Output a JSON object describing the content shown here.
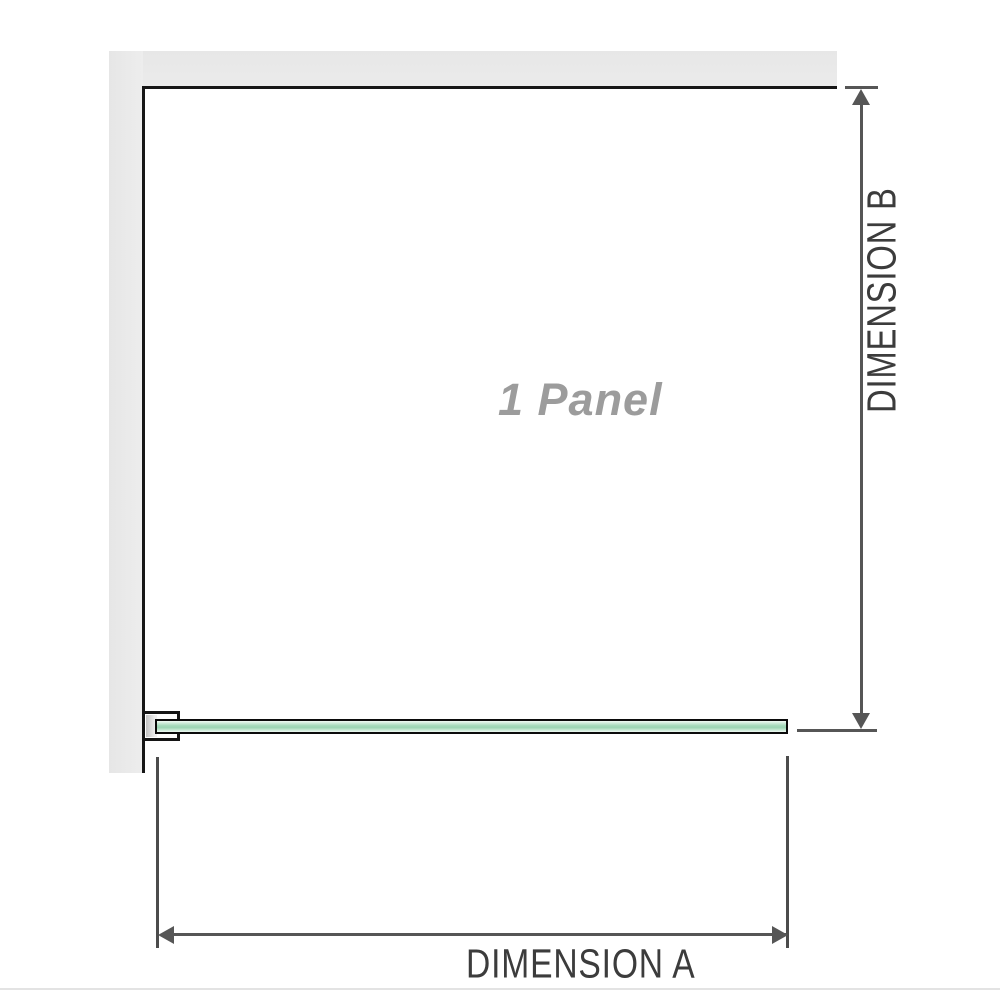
{
  "diagram": {
    "panel_label": "1 Panel",
    "dimension_a": {
      "label": "DIMENSION A",
      "orientation": "horizontal",
      "measures": "panel width"
    },
    "dimension_b": {
      "label": "DIMENSION B",
      "orientation": "vertical",
      "measures": "panel height"
    },
    "parts": {
      "wall": "L-shaped wall shown top and left",
      "glass": "single glass panel shown in plan view with wall bracket at left end"
    }
  },
  "colors": {
    "background": "#ffffff",
    "wall_gray": "#e9e9e9",
    "panel_outline": "#161616",
    "dimension_line": "#565656",
    "dimension_text": "#3c3c3c",
    "panel_label_text": "#9c9c9c",
    "glass_green": "#a6dabb",
    "glass_green_light": "#cdebd9",
    "glass_border": "#0b0b0b",
    "bracket_gray": "#c3c3c3",
    "bottom_rule": "#e3e3e3"
  }
}
